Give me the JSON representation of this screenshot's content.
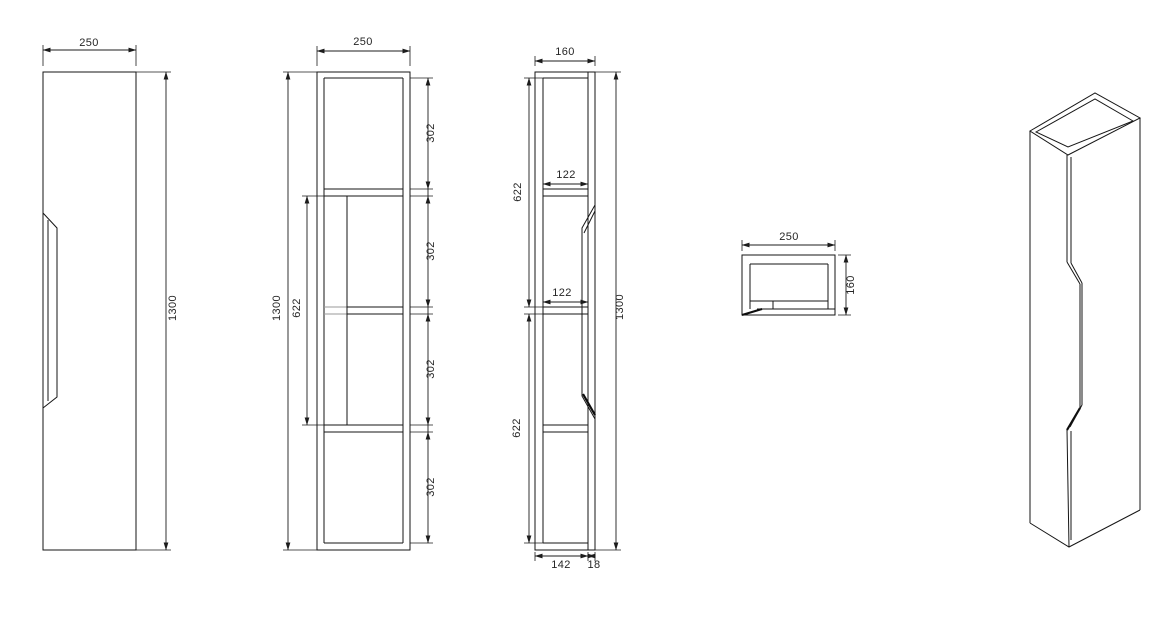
{
  "drawing": {
    "background": "#ffffff",
    "line_color": "#161616",
    "views": {
      "front": {
        "width": "250",
        "height": "1300"
      },
      "internal": {
        "width": "250",
        "height": "1300",
        "middle_span": "622",
        "comp1": "302",
        "comp2": "302",
        "comp3": "302",
        "comp4": "302"
      },
      "side": {
        "depth": "160",
        "height": "1300",
        "shelf1_depth": "122",
        "shelf2_depth": "122",
        "upper_section": "622",
        "lower_section": "622",
        "body_depth": "142",
        "door_thickness": "18"
      },
      "top": {
        "width": "250",
        "depth": "160"
      }
    }
  }
}
